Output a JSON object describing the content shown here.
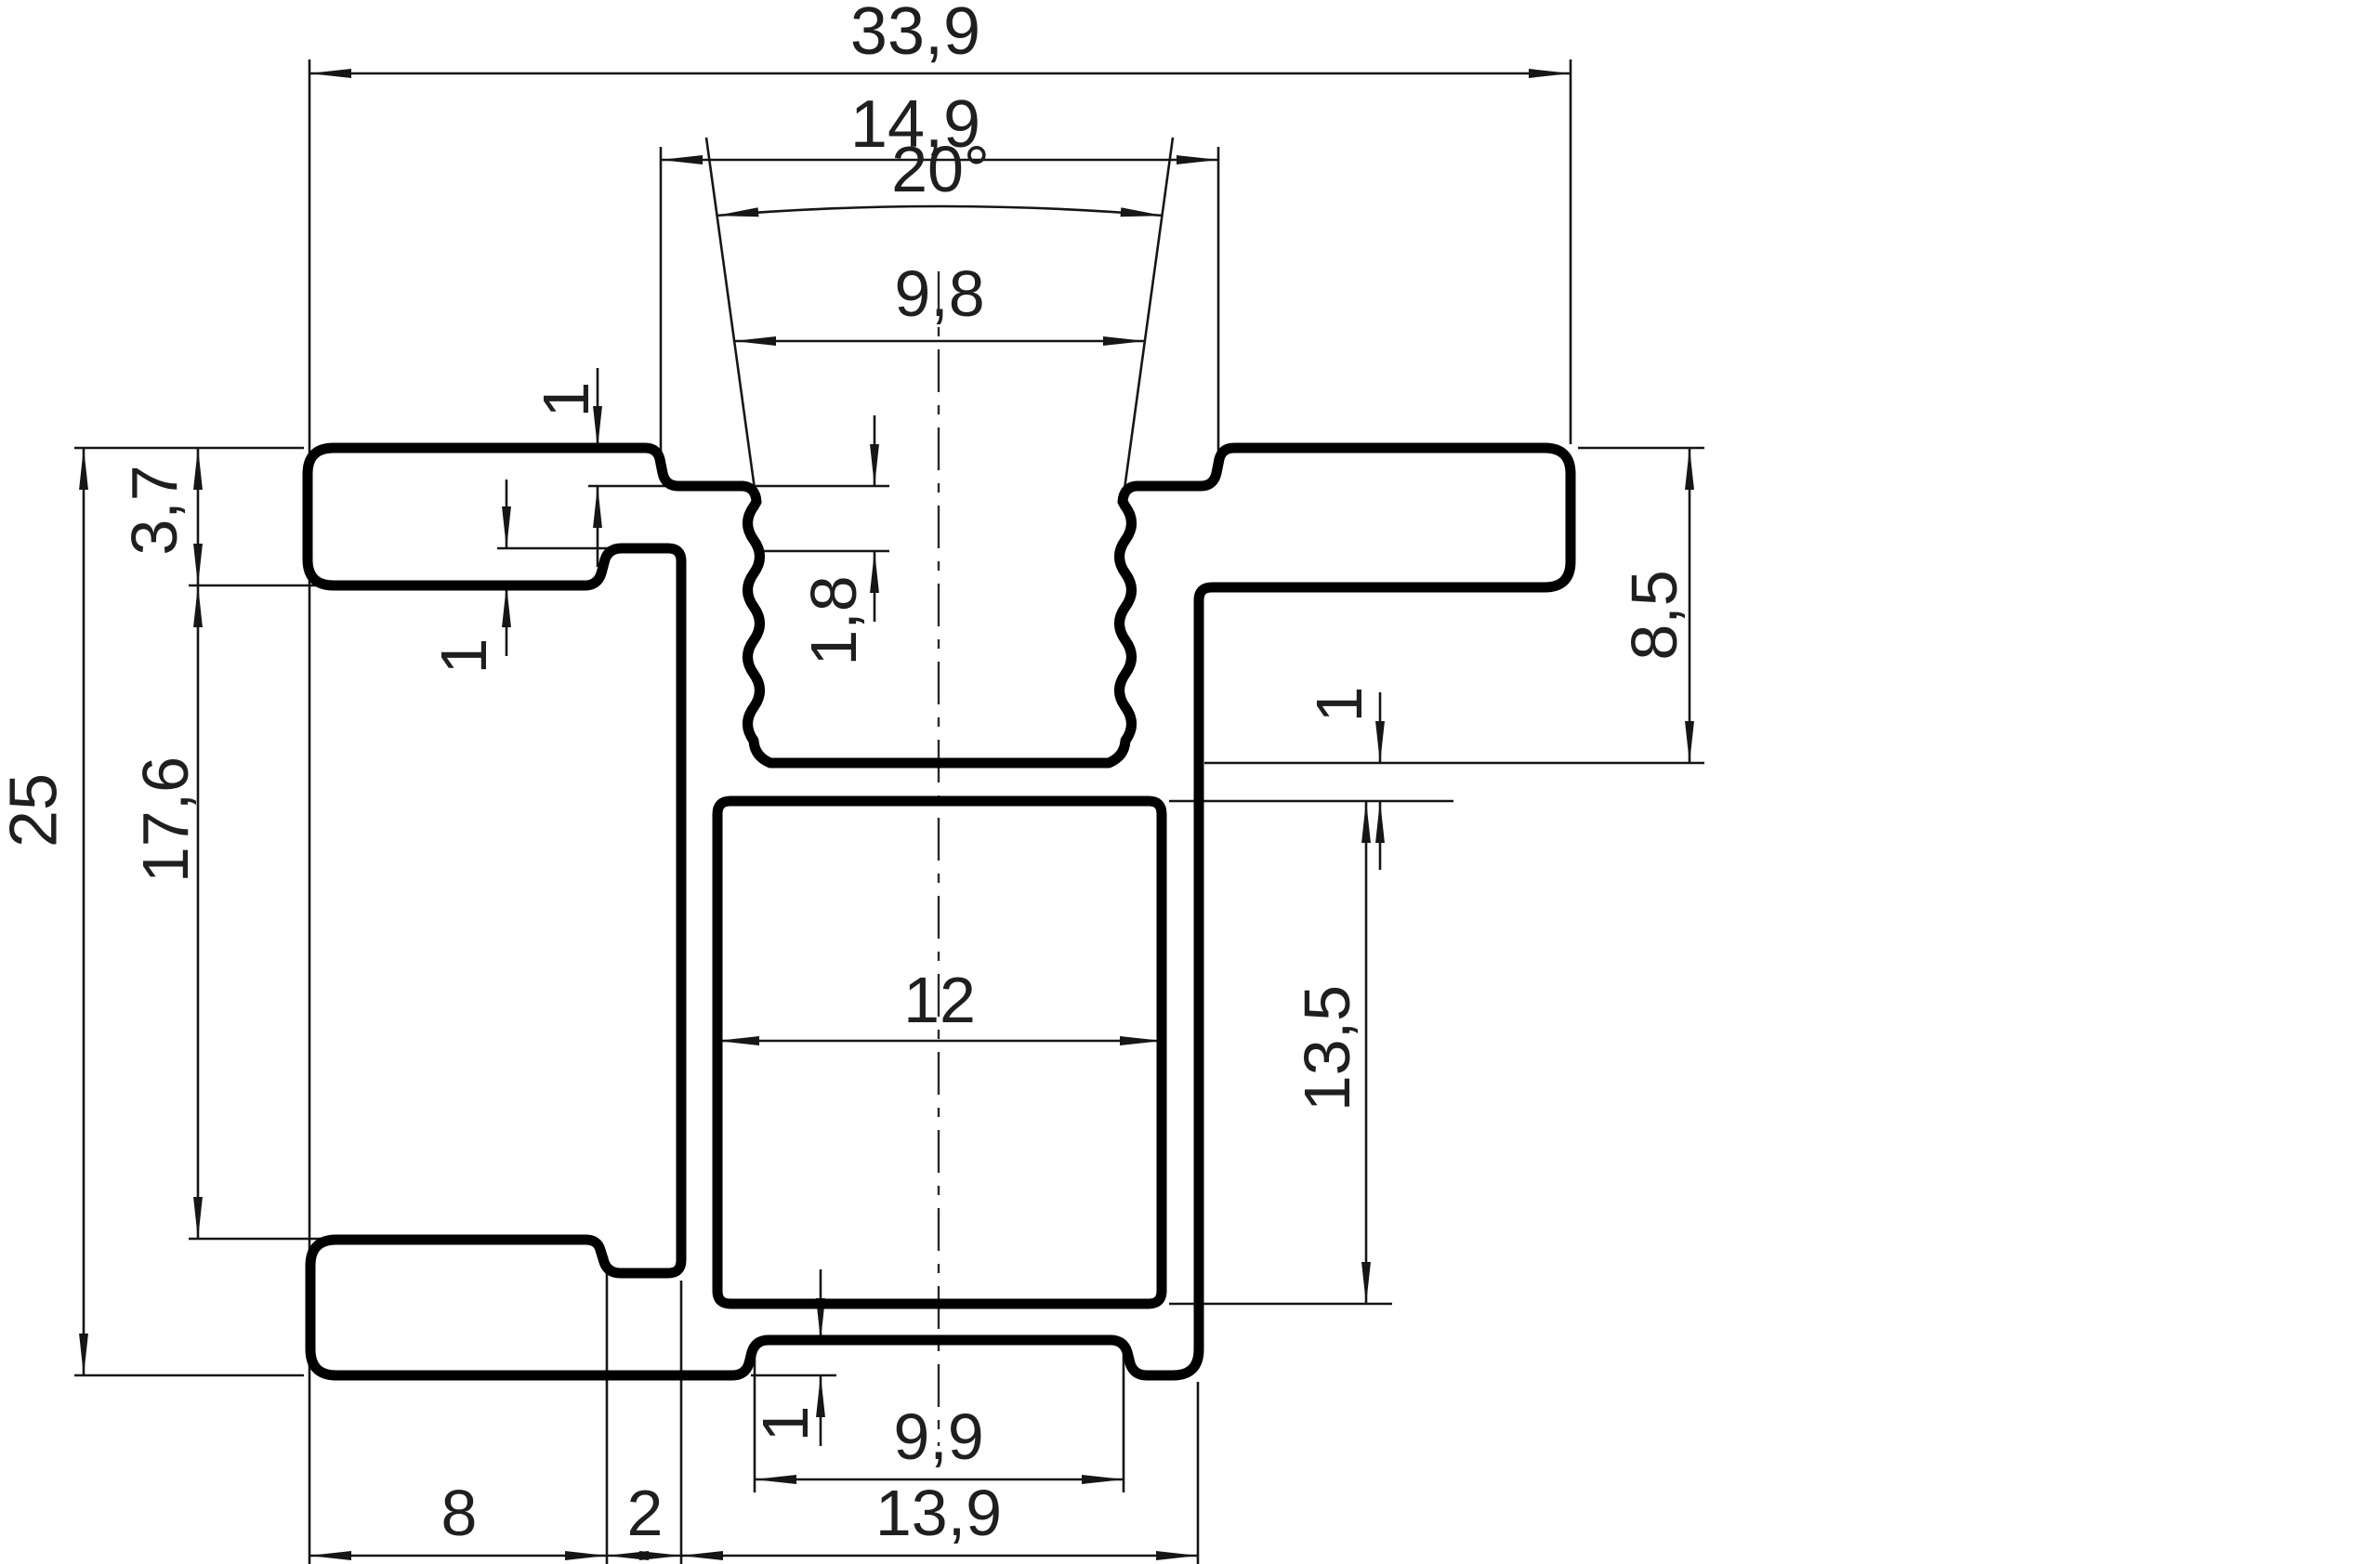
{
  "drawing": {
    "type": "technical-cross-section",
    "background": "#ffffff",
    "line_color": "#000000",
    "text_color": "#1f1f1f",
    "dims": {
      "overall_width": "33,9",
      "boss_width": "14,9",
      "thread_angle": "20°",
      "thread_opening": "9,8",
      "top_step": "1",
      "arm_thickness": "3,7",
      "arm_notch_step": "1",
      "thread_lead": "1,8",
      "overall_height": "25",
      "side_height": "17,6",
      "channel_depth": "8,5",
      "top_wall": "1",
      "cavity_height": "13,5",
      "cavity_width": "12",
      "foot_step": "1",
      "tab_width": "9,9",
      "base_width": "13,9",
      "foot_width": "8",
      "leg_offset": "2"
    }
  }
}
